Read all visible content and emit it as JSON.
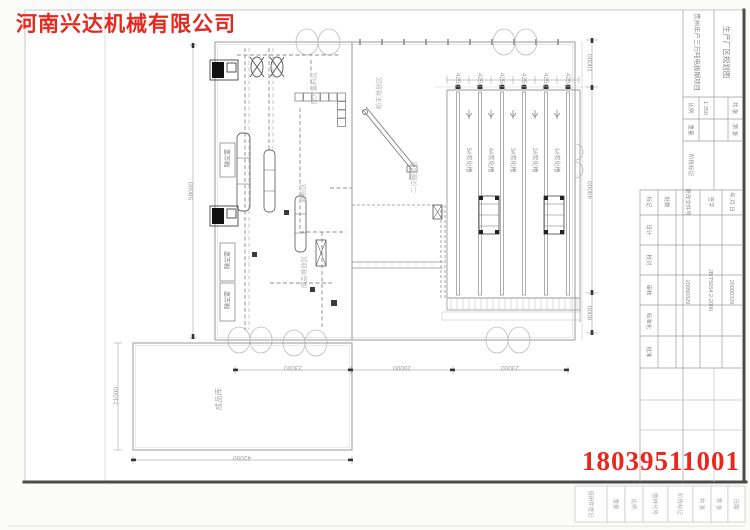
{
  "colors": {
    "accent_red": "#e8281e",
    "line_gray": "#9a9a9a"
  },
  "company": {
    "name": "河南兴达机械有限公司"
  },
  "watermark": {
    "phone": "18039511001"
  },
  "plan": {
    "areas": {
      "batching": "配方集料区",
      "powder": "粉末堆放区",
      "secondary": "二次搬运区",
      "finished_stack": "成品堆放区",
      "milling": "磨粉区",
      "dust_room": "除尘室",
      "warehouse": "成品库"
    },
    "lanes": [
      "5#炭化槽",
      "4#炭化槽",
      "3#炭化槽",
      "2#炭化槽",
      "1#炭化槽"
    ],
    "dims": {
      "left": "58000",
      "bottom": [
        "23000",
        "20000",
        "23000"
      ],
      "right": [
        "10000",
        "40000",
        "8000"
      ],
      "lane": "4250",
      "wh_width": "42000",
      "wh_height": "21000"
    }
  },
  "titleblock": {
    "project": "贵州年产三万吨电极糊项目",
    "title": "生产厂区规划图",
    "scale_label": "比例",
    "scale": "1:350",
    "weight_label": "重量",
    "stage_label": "阶段标记",
    "sheets_total": "共 张",
    "sheet_no": "第 张",
    "rev_headers": [
      "标记",
      "处数",
      "更改文件号",
      "签字",
      "年.月.日"
    ],
    "sign_rows": [
      "设计",
      "校对",
      "审核",
      "标准化",
      "批准"
    ],
    "dates": [
      "20090329",
      "20090329"
    ],
    "std": "JB/T5054.2-2000"
  },
  "bottom_strip": {
    "labels": [
      "借用件登记",
      "重量",
      "比例",
      "图样代号",
      "阶段标记",
      "共 张",
      "第 张",
      "日期"
    ]
  }
}
